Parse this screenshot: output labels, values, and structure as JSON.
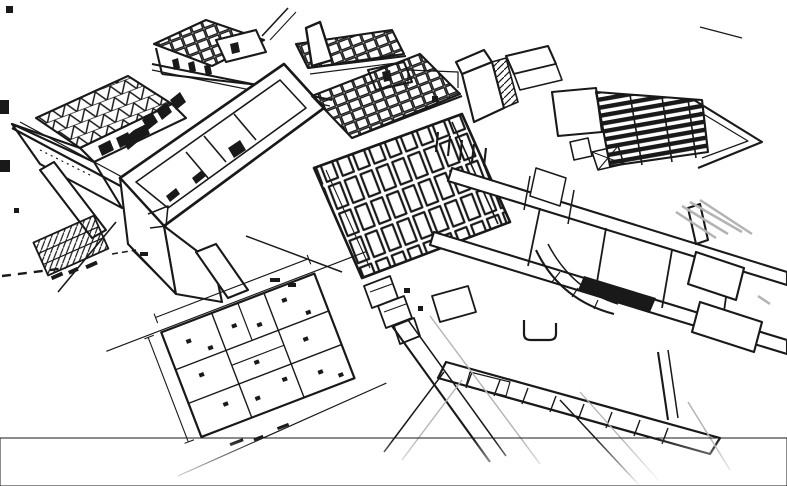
{
  "scene": {
    "title": "Architectural concept sketch",
    "medium": "monochrome line sketch, pencil style",
    "view": "aerial axonometric cutaway of a building complex",
    "background_color": "#ffffff",
    "ink_color": "#191919",
    "faded_stroke_color": "#b3b3b3",
    "description": "Hand-drawn style monochrome sketch of a building model: an aerial cutaway axonometric of interlocking building wings with exposed triangular roof trusses at the top left, a gridded joist roof over the central block, a dark louvered roof panel at the top right, open-top wings with thick parapet walls and dark window slots, a long foreground slab building with beams, partitions, a curved ramp and terraces, a rotated 2D floor plan sketch at the lower left, a small hatched stepped terrace on the left, and crossing site paths that fade out toward the bottom edge.",
    "elements": [
      {
        "name": "margin-marks",
        "description": "Small stray ink marks along the left margin"
      },
      {
        "name": "truss-roof-building",
        "description": "Low wing with exposed triangular roof trusses, top left"
      },
      {
        "name": "annex-grid-roof",
        "description": "Small annex with gridded roof deck, top"
      },
      {
        "name": "upper-clerestory-band",
        "description": "Narrow clerestory band with braced deck and pointed end wall"
      },
      {
        "name": "left-wing-cutaway",
        "description": "Open-top wing with thick parapet walls, dark window slots and interior partitions"
      },
      {
        "name": "rib-deck",
        "description": "Band of closely spaced roof ribs between wings"
      },
      {
        "name": "center-joist-grid",
        "description": "Large exposed joist grid over the central block"
      },
      {
        "name": "tower-room",
        "description": "Tall cutaway room volume with hatched side wall, top center-right"
      },
      {
        "name": "louver-roof",
        "description": "Dark louvered roof panel with chevron edge, top right"
      },
      {
        "name": "right-building",
        "description": "Long foreground building slab with beams, partitions, curved ramp, terraces and faded pencil shading"
      },
      {
        "name": "pier-band",
        "description": "Long walkway band with cross ticks and rounded hook detail, bottom center"
      },
      {
        "name": "site-roads",
        "description": "Crossing site paths fading toward the bottom edge"
      },
      {
        "name": "floor-plan-sketch",
        "description": "Rotated 2D floor plan with room partitions, dimension lines and scattered annotation ticks, lower left"
      },
      {
        "name": "stepped-terrace",
        "description": "Small hatched stepped structure with ramp and dashed ground line, left"
      }
    ]
  }
}
